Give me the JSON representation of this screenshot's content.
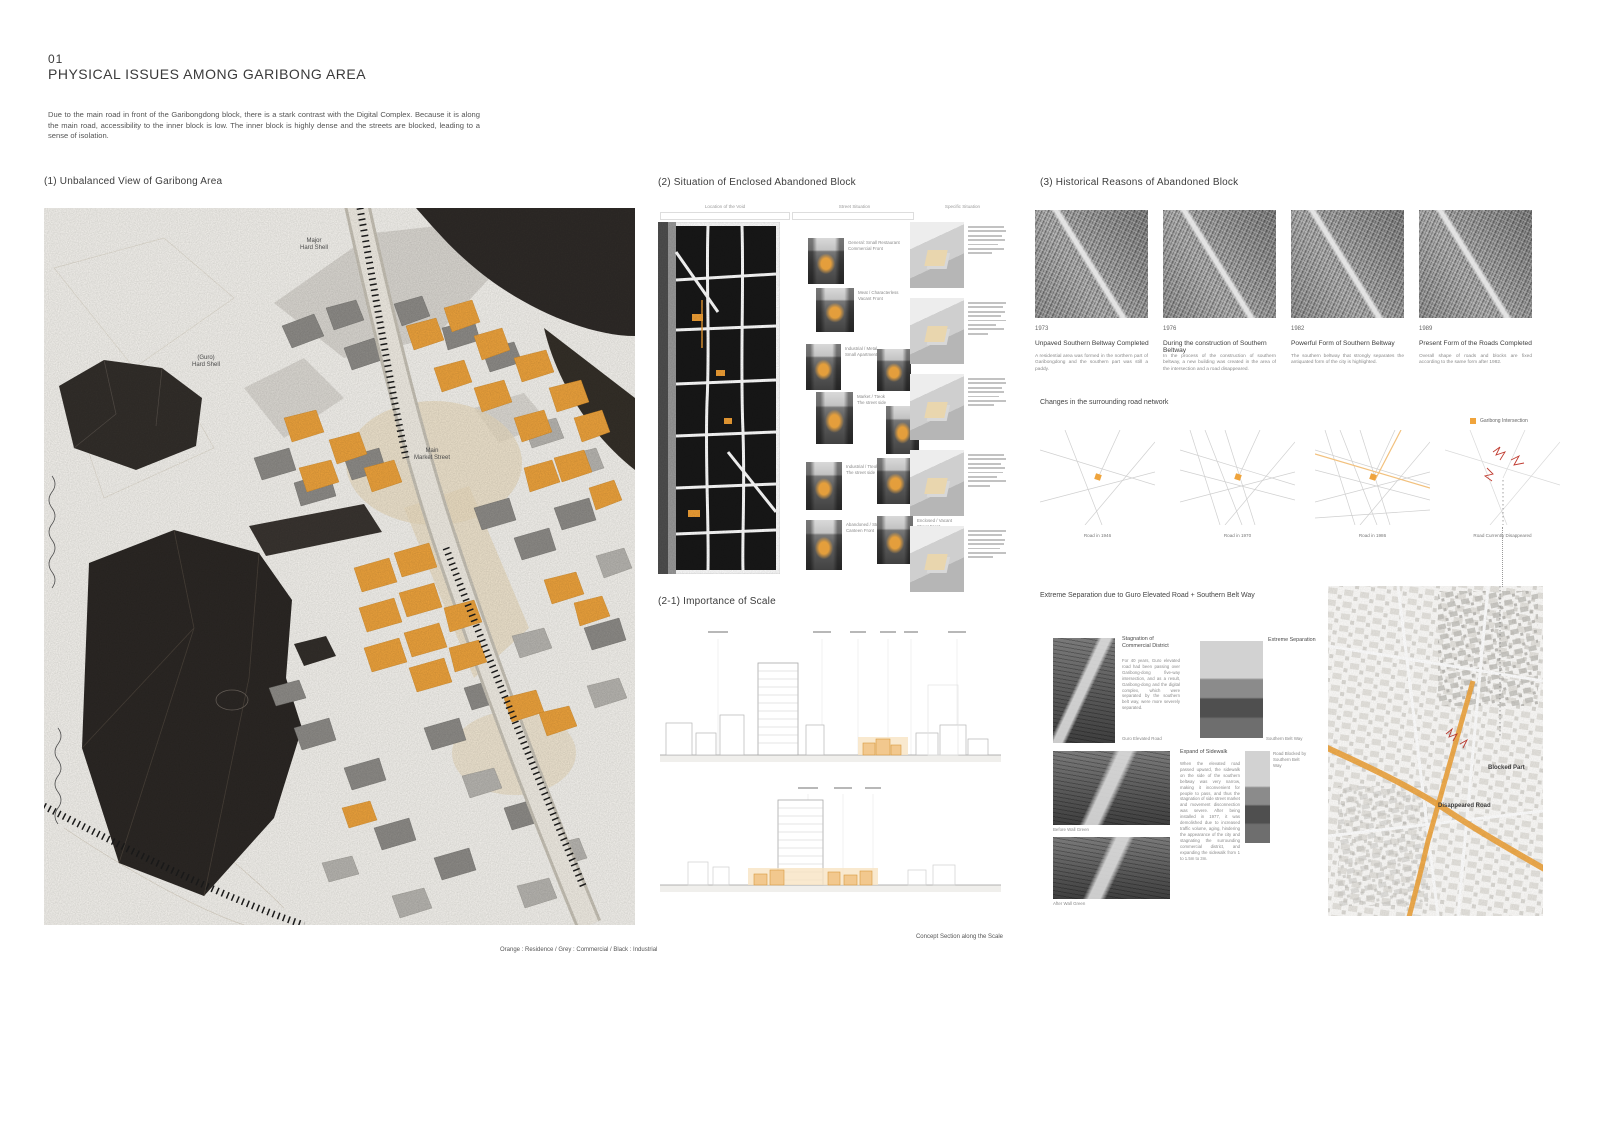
{
  "header": {
    "number": "01",
    "title": "PHYSICAL ISSUES AMONG GARIBONG AREA",
    "intro": "Due to the main road in front of the Garibongdong block, there is a stark contrast with the Digital Complex. Because it is along the main road, accessibility to the inner block is low. The inner block is highly dense and the streets are blocked, leading to a sense of isolation."
  },
  "panel1": {
    "title": "(1) Unbalanced View of Garibong Area",
    "caption": "Orange : Residence / Grey : Commercial / Black : Industrial",
    "labels": {
      "major1": "Major",
      "major2": "Hard Shell",
      "guro1": "(Guro)",
      "guro2": "Hard Shell",
      "market1": "Main",
      "market2": "Market Street"
    }
  },
  "panel2": {
    "title": "(2) Situation of Enclosed Abandoned Block",
    "columns": [
      "Location of the Void",
      "Street Situation",
      "Specific Situation"
    ],
    "photos": [
      {
        "l1": "General: Small Restaurant",
        "l2": "Commercial Front"
      },
      {
        "l1": "Meat / Characterless",
        "l2": "Vacant Front"
      },
      {
        "l1": "Industrial / Metal",
        "l2": "Small Apartment Front"
      },
      {
        "l1": "Metal / House",
        "l2": "House Front"
      },
      {
        "l1": "Market / Tteok",
        "l2": "The street side"
      },
      {
        "l1": "Proper / House",
        "l2": "Vacant Front"
      },
      {
        "l1": "Industrial / Tteok",
        "l2": "The street side"
      },
      {
        "l1": "Market / Meat",
        "l2": "The street side"
      },
      {
        "l1": "Abandoned / Street",
        "l2": "Canteen Front"
      },
      {
        "l1": "Enclosed / Vacant",
        "l2": "Street Front"
      }
    ]
  },
  "panel21": {
    "title": "(2-1) Importance of Scale",
    "caption": "Concept Section along the Scale"
  },
  "panel3": {
    "title": "(3) Historical Reasons of Abandoned Block",
    "history": [
      {
        "year": "1973",
        "title": "Unpaved Southern Beltway Completed",
        "text": "A residential area was formed in the northern part of Garibongdong and the southern part was still a paddy."
      },
      {
        "year": "1976",
        "title": "During the construction of Southern Beltway",
        "text": "In the process of the construction of southern beltway, a new building was created in the area of the intersection and a road disappeared."
      },
      {
        "year": "1982",
        "title": "Powerful Form of Southern Beltway",
        "text": "The southern beltway that strongly separates the antiquated form of the city is highlighted."
      },
      {
        "year": "1989",
        "title": "Present Form of the Roads Completed",
        "text": "Overall shape of roads and blocks are fixed according to the same form after 1982."
      }
    ],
    "network": {
      "title": "Changes in the surrounding road network",
      "legend": "Garibong Intersection",
      "maps": [
        "Road in 1946",
        "Road in 1970",
        "Road in 1986",
        "Road Currently Disappeared"
      ]
    },
    "separation": {
      "title": "Extreme Separation due to Guro Elevated Road + Southern Belt Way",
      "block1_title": "Stagnation of Commercial District",
      "block1_text": "For 40 years, Guro elevated road had been passing over Garibong-dong five-way intersection, and as a result, Garibong-dong and the digital complex, which were separated by the southern belt way, were more severely separated.",
      "photo1_caption": "Guro Elevated Road",
      "photo2_label": "Extreme Separation",
      "photo2_caption": "Southern Belt Way",
      "block2_title": "Expand of Sidewalk",
      "block2_text": "When the elevated road passed upward, the sidewalk on the side of the southern beltway was very narrow, making it inconvenient for people to pass, and thus the stagnation of side street market and movement disconnection was severe. After being installed in 1977, it was demolished due to increased traffic volume, aging, hindering the appearance of the city and stagnating the surrounding commercial district, and expanding the sidewalk from 1 to 1.5m to 3m.",
      "photo3_caption": "Before Wall Green",
      "photo4_caption": "After Wall Green",
      "photo5_label": "Road Blocked by Southern Belt Way"
    },
    "map": {
      "blocked": "Blocked Part",
      "disappeared": "Disappeared Road"
    }
  }
}
